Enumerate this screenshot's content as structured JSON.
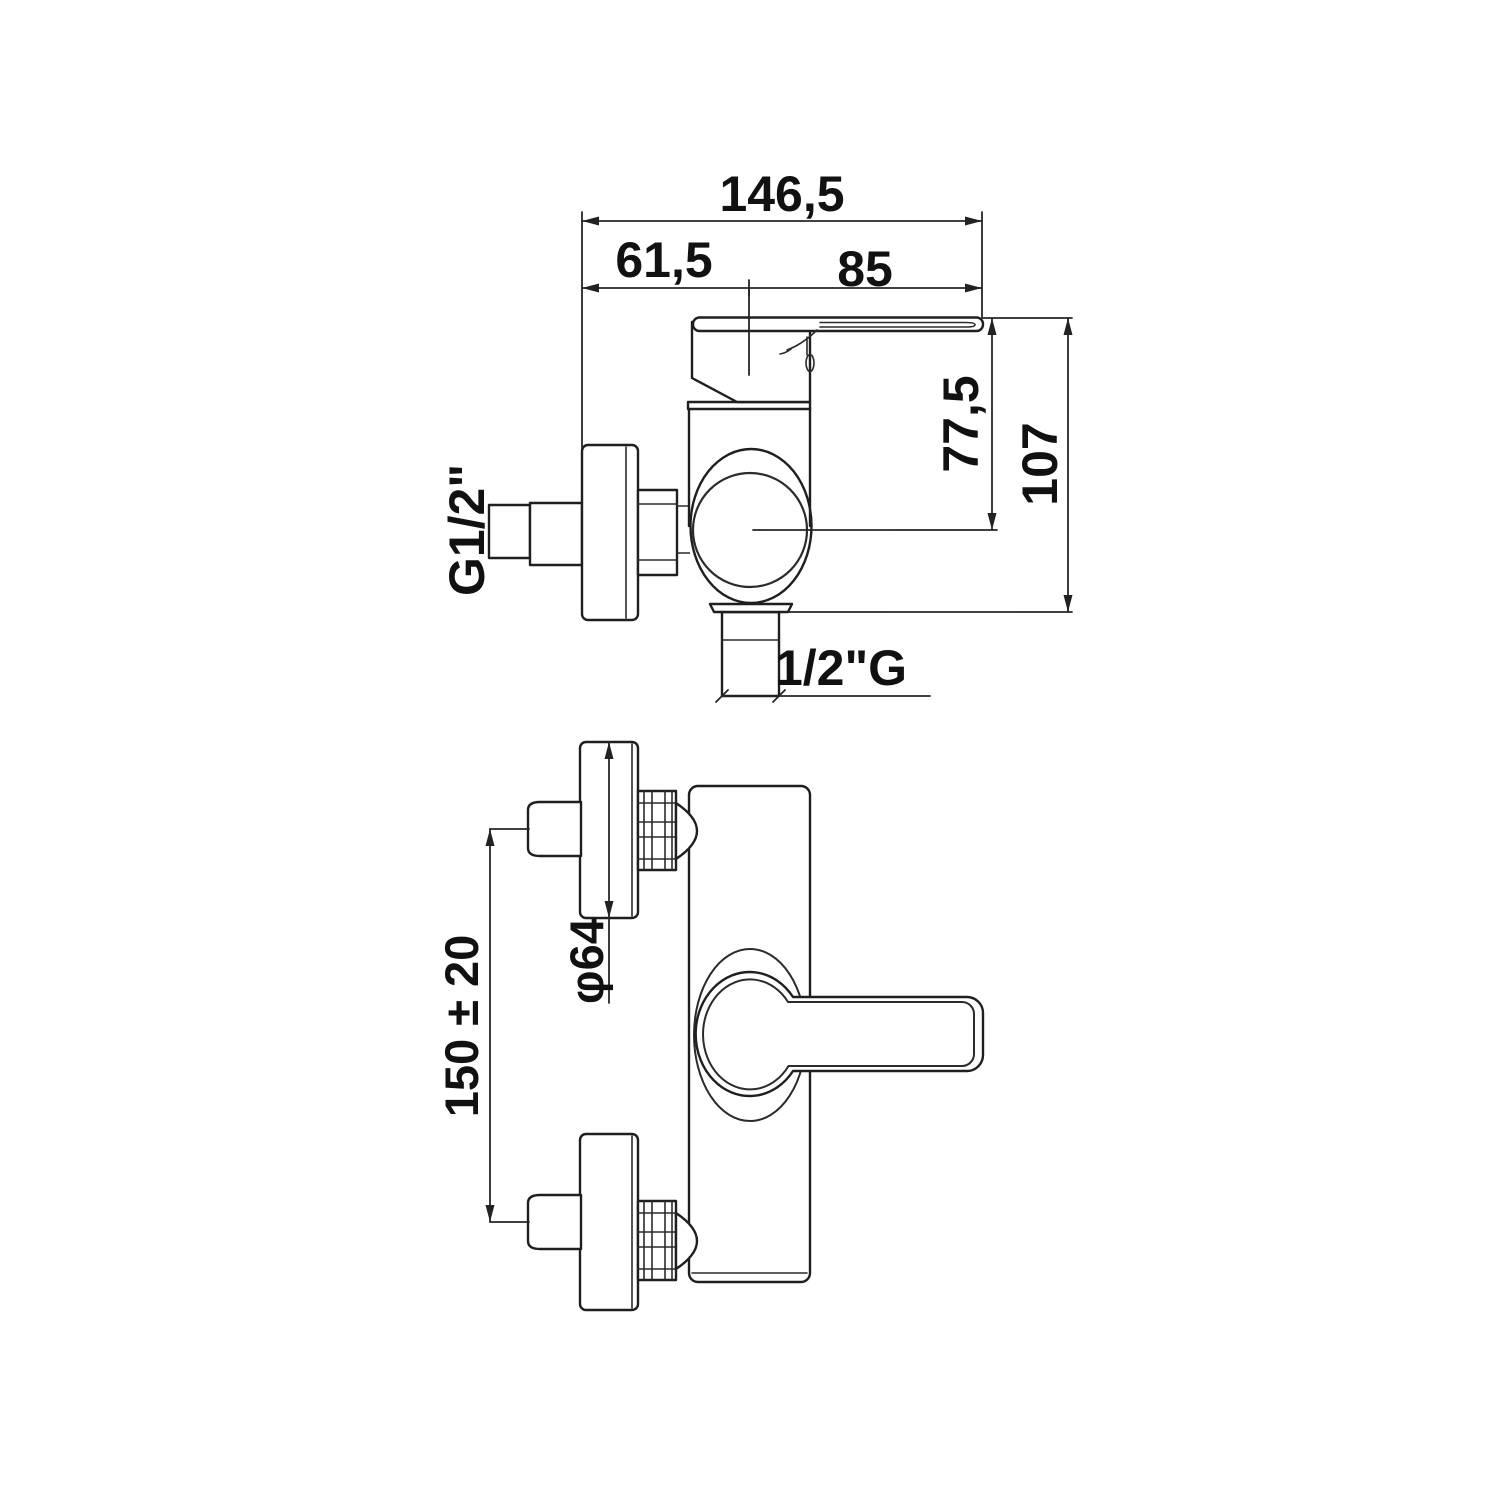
{
  "drawing": {
    "background": "#ffffff",
    "line_color": "#1f1f1f",
    "text_color": "#111111",
    "views": {
      "side_view": "faucet-side-view",
      "front_view": "faucet-front-view"
    },
    "dimensions": {
      "overall_width": "146,5",
      "left_section": "61,5",
      "handle_section": "85",
      "center_height": "77,5",
      "overall_height": "107",
      "inlet_thread": "G1/2\"",
      "outlet_thread": "1/2\"G",
      "flange_diameter": "φ64",
      "connection_spacing": "150 ± 20"
    }
  }
}
